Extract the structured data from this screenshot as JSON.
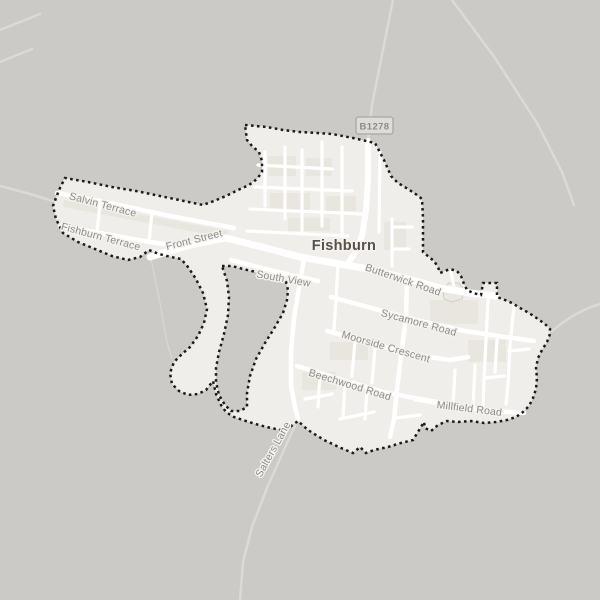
{
  "map": {
    "place": {
      "name": "Fishburn"
    },
    "route_badge": {
      "label": "B1278"
    },
    "roads": [
      {
        "name": "Salvin Terrace"
      },
      {
        "name": "Fishburn Terrace"
      },
      {
        "name": "Front Street"
      },
      {
        "name": "South View"
      },
      {
        "name": "Butterwick Road"
      },
      {
        "name": "Sycamore Road"
      },
      {
        "name": "Moorside Crescent"
      },
      {
        "name": "Beechwood Road"
      },
      {
        "name": "Millfield Road"
      },
      {
        "name": "Salters Lane"
      }
    ],
    "colors": {
      "background_outside": "#cbcac6",
      "urban_area": "#f0eeea",
      "residential_block": "#e9e6e0",
      "road_fill": "#ffffff",
      "faint_road_outside": "#dcdad6",
      "boundary_dots": "#1b1b1b",
      "road_label_text": "#8e8c87",
      "place_label_text": "#575149",
      "badge_background": "#dedcd8",
      "badge_border": "#a9a7a3",
      "badge_text": "#8d8b86"
    }
  }
}
